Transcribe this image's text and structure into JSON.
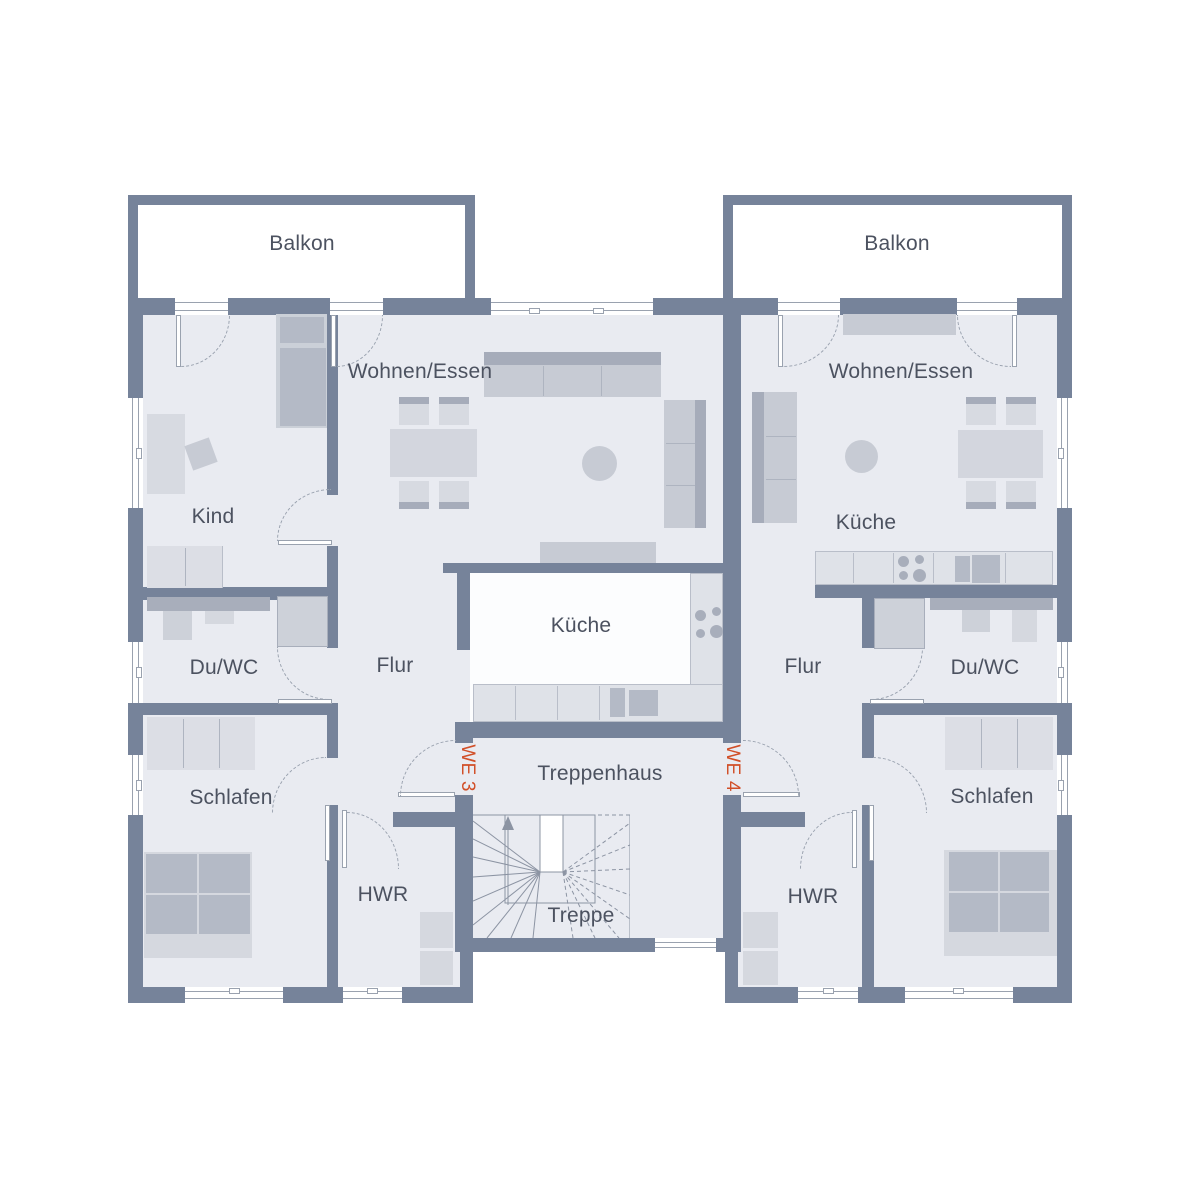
{
  "colors": {
    "wall": "#76839A",
    "floor": "#E9EBF1",
    "kitchen_floor_white": "#FCFDFE",
    "accent_orange": "#D14F28",
    "label_text": "#4C5260",
    "thin_line": "#9AA2AF",
    "furniture_light": "#D7DAE1",
    "furniture_mid": "#C7CBD4",
    "furniture_dark": "#B4BAC6"
  },
  "plan": {
    "balconies": {
      "left": "Balkon",
      "right": "Balkon"
    },
    "stairwell": {
      "name": "Treppenhaus",
      "stairs": "Treppe"
    },
    "units": {
      "left": {
        "id": "WE 3",
        "living": "Wohnen/Essen",
        "child": "Kind",
        "kitchen": "Küche",
        "hall": "Flur",
        "bath": "Du/WC",
        "bedroom": "Schlafen",
        "utility": "HWR"
      },
      "right": {
        "id": "WE 4",
        "living": "Wohnen/Essen",
        "kitchen": "Küche",
        "hall": "Flur",
        "bath": "Du/WC",
        "bedroom": "Schlafen",
        "utility": "HWR"
      }
    }
  }
}
